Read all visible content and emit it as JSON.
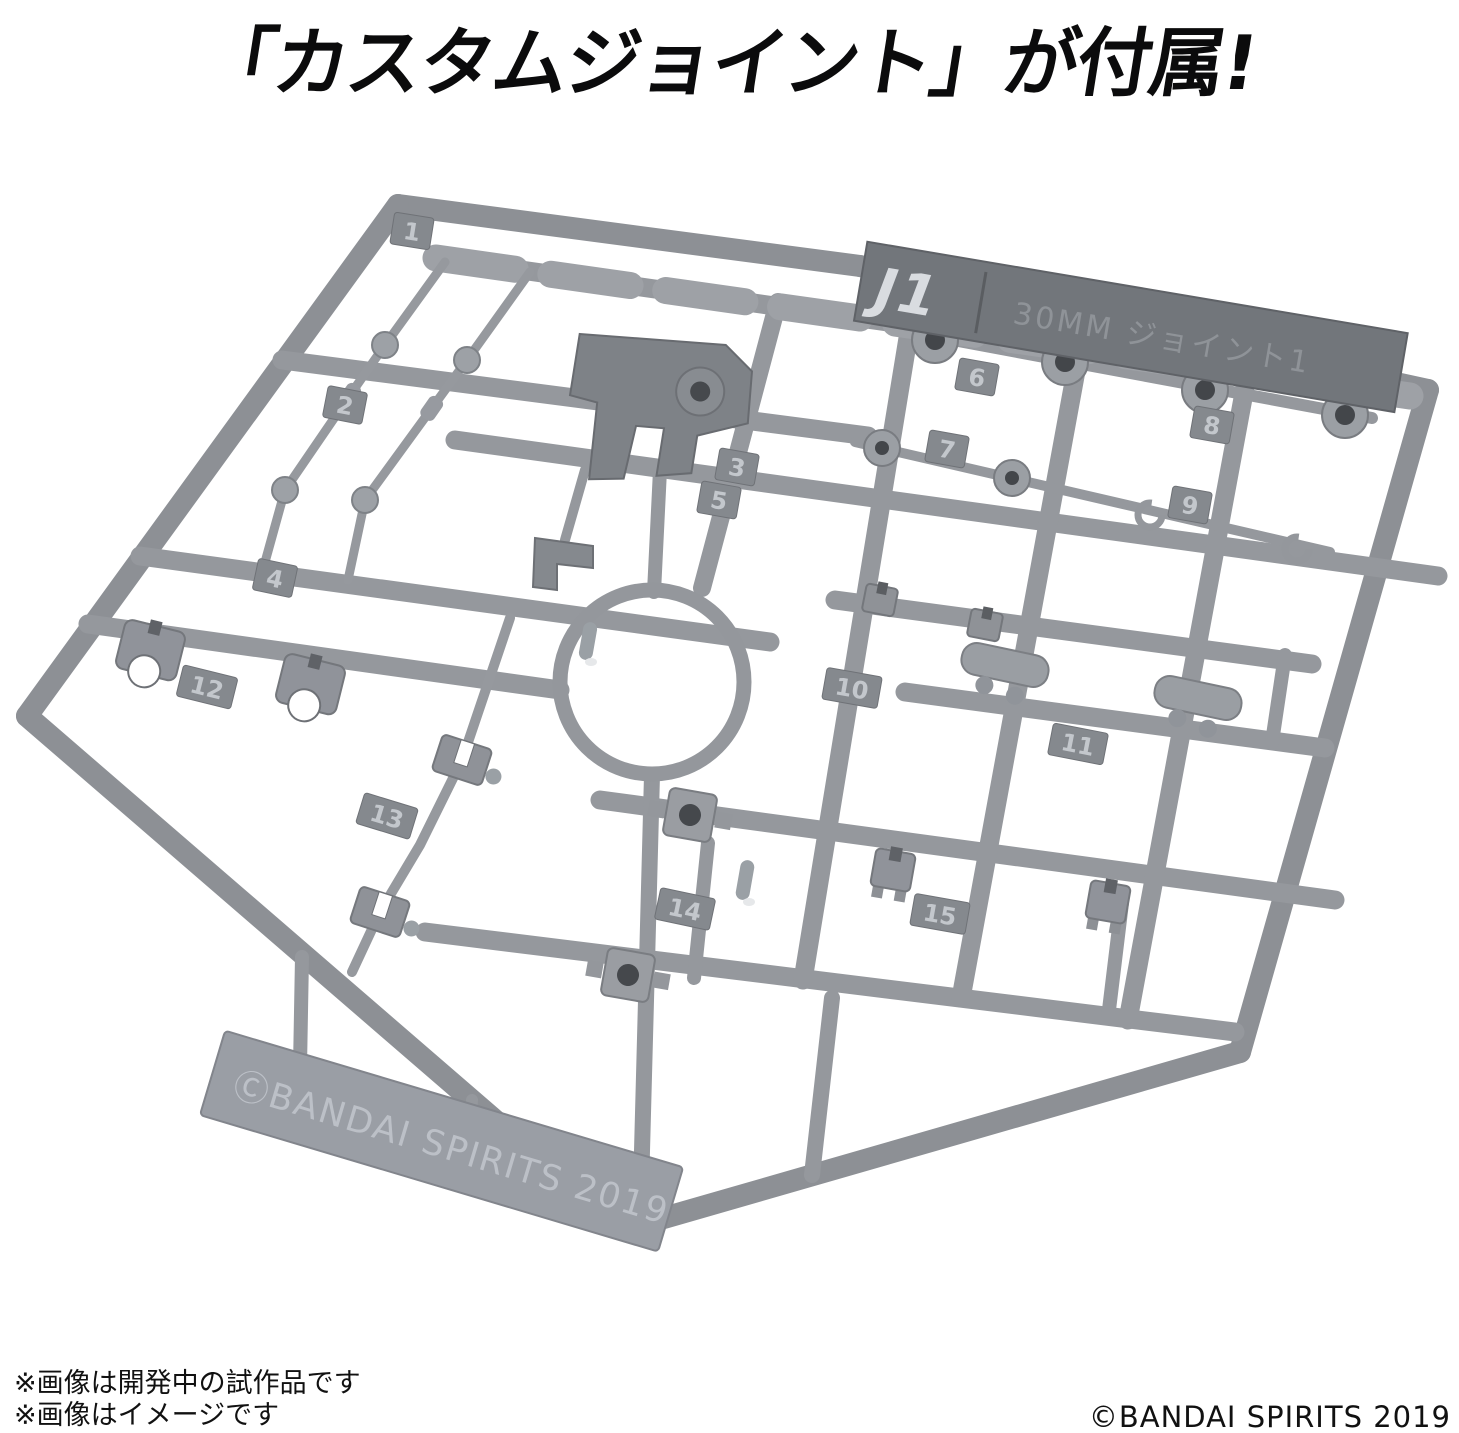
{
  "title": {
    "text": "「カスタムジョイント」が付属!"
  },
  "sprue": {
    "plate_code": "J1",
    "plate_label": "30MM ジョイント1",
    "molded_copyright": "ⒸBANDAI SPIRITS 2019",
    "part_numbers": [
      "1",
      "2",
      "3",
      "4",
      "5",
      "6",
      "7",
      "8",
      "9",
      "10",
      "11",
      "12",
      "13",
      "14",
      "15"
    ]
  },
  "footer": {
    "note1": "※画像は開発中の試作品です",
    "note2": "※画像はイメージです",
    "copyright": "©BANDAI SPIRITS 2019"
  },
  "colors": {
    "background": "#ffffff",
    "plastic": "#95989d",
    "plastic_dark": "#72767b",
    "plastic_light": "#c3c7cc",
    "text": "#0b0b0c"
  }
}
